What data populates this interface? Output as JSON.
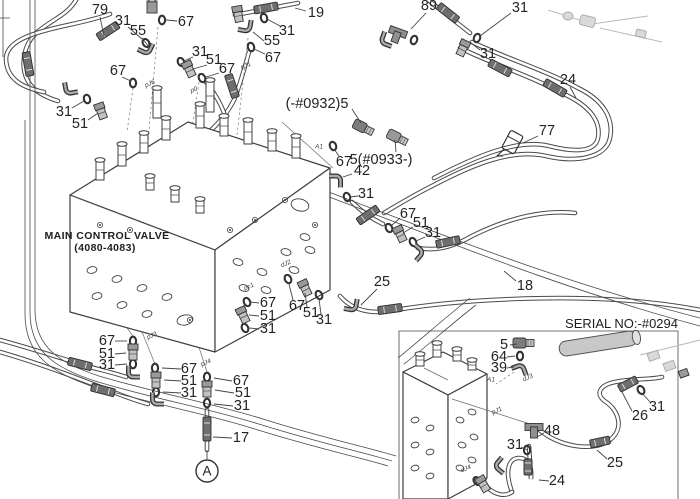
{
  "colors": {
    "background": "#ffffff",
    "line": "#4a4a4a",
    "label_text": "#232323",
    "sleeve": "#6e6e6e",
    "fitting": "#8f8f8f",
    "faded_part": "#bdbdbd"
  },
  "main_valve": {
    "label_line1": "MAIN CONTROL VALVE",
    "label_line2": "(4080-4083)"
  },
  "inset": {
    "serial_label": "SERIAL NO:-#0294"
  },
  "balloon": {
    "letter": "A"
  },
  "part_labels": [
    {
      "text": "79",
      "x": 100,
      "y": 10,
      "leader": [
        100,
        17,
        104,
        36
      ]
    },
    {
      "text": "31",
      "x": 123,
      "y": 21,
      "leader": [
        128,
        27,
        142,
        39
      ]
    },
    {
      "text": "55",
      "x": 138,
      "y": 31,
      "leader": [
        142,
        38,
        149,
        47
      ]
    },
    {
      "text": "67",
      "x": 186,
      "y": 22,
      "leader": [
        177,
        21,
        166,
        20
      ]
    },
    {
      "text": "31",
      "x": 200,
      "y": 52,
      "leader": [
        193,
        57,
        184,
        61
      ]
    },
    {
      "text": "51",
      "x": 214,
      "y": 60,
      "leader": [
        207,
        65,
        193,
        69
      ]
    },
    {
      "text": "67",
      "x": 227,
      "y": 69,
      "leader": [
        219,
        73,
        206,
        77
      ]
    },
    {
      "text": "67",
      "x": 118,
      "y": 71,
      "leader": [
        122,
        77,
        131,
        81
      ]
    },
    {
      "text": "31",
      "x": 64,
      "y": 112,
      "leader": [
        72,
        108,
        84,
        101
      ]
    },
    {
      "text": "51",
      "x": 80,
      "y": 124,
      "leader": [
        88,
        120,
        98,
        113
      ]
    },
    {
      "text": "19",
      "x": 316,
      "y": 13,
      "leader": [
        306,
        11,
        295,
        8
      ]
    },
    {
      "text": "31",
      "x": 287,
      "y": 31,
      "leader": [
        280,
        26,
        267,
        19
      ]
    },
    {
      "text": "55",
      "x": 272,
      "y": 41,
      "leader": [
        264,
        41,
        253,
        32
      ]
    },
    {
      "text": "67",
      "x": 273,
      "y": 58,
      "leader": [
        265,
        54,
        254,
        49
      ]
    },
    {
      "text": "89",
      "x": 429,
      "y": 6,
      "leader": [
        426,
        13,
        411,
        29
      ]
    },
    {
      "text": "31",
      "x": 520,
      "y": 8,
      "leader": [
        511,
        13,
        480,
        36
      ]
    },
    {
      "text": "31",
      "x": 488,
      "y": 54,
      "leader": [
        480,
        50,
        470,
        42
      ]
    },
    {
      "text": "24",
      "x": 568,
      "y": 80,
      "leader": [
        570,
        87,
        576,
        98
      ]
    },
    {
      "text": "77",
      "x": 547,
      "y": 131,
      "leader": [
        538,
        136,
        523,
        143
      ]
    },
    {
      "text": "(-#0932)5",
      "x": 317,
      "y": 104,
      "leader": [
        352,
        109,
        361,
        123
      ]
    },
    {
      "text": "5(#0933-)",
      "x": 381,
      "y": 160,
      "leader": [
        396,
        152,
        395,
        140
      ]
    },
    {
      "text": "67",
      "x": 344,
      "y": 162,
      "leader": [
        339,
        156,
        334,
        149
      ]
    },
    {
      "text": "42",
      "x": 362,
      "y": 171,
      "leader": [
        352,
        174,
        343,
        177
      ]
    },
    {
      "text": "31",
      "x": 366,
      "y": 194,
      "leader": [
        358,
        196,
        350,
        197
      ]
    },
    {
      "text": "67",
      "x": 408,
      "y": 214,
      "leader": [
        400,
        218,
        391,
        226
      ]
    },
    {
      "text": "51",
      "x": 421,
      "y": 223,
      "leader": [
        413,
        227,
        403,
        233
      ]
    },
    {
      "text": "31",
      "x": 433,
      "y": 233,
      "leader": [
        425,
        237,
        416,
        241
      ]
    },
    {
      "text": "25",
      "x": 382,
      "y": 282,
      "leader": [
        377,
        289,
        361,
        305
      ]
    },
    {
      "text": "18",
      "x": 525,
      "y": 286,
      "leader": [
        516,
        281,
        504,
        271
      ]
    },
    {
      "text": "67",
      "x": 268,
      "y": 303,
      "leader": [
        259,
        303,
        250,
        302
      ]
    },
    {
      "text": "51",
      "x": 268,
      "y": 316,
      "leader": [
        259,
        316,
        249,
        315
      ]
    },
    {
      "text": "31",
      "x": 268,
      "y": 329,
      "leader": [
        259,
        329,
        249,
        328
      ]
    },
    {
      "text": "67",
      "x": 297,
      "y": 306,
      "leader": [
        293,
        300,
        289,
        284
      ]
    },
    {
      "text": "51",
      "x": 311,
      "y": 313,
      "leader": [
        307,
        307,
        305,
        293
      ]
    },
    {
      "text": "31",
      "x": 324,
      "y": 320,
      "leader": [
        321,
        314,
        319,
        299
      ]
    },
    {
      "text": "67",
      "x": 107,
      "y": 341,
      "leader": [
        115,
        341,
        127,
        341
      ]
    },
    {
      "text": "51",
      "x": 107,
      "y": 354,
      "leader": [
        115,
        354,
        126,
        353
      ]
    },
    {
      "text": "31",
      "x": 107,
      "y": 365,
      "leader": [
        115,
        365,
        127,
        364
      ]
    },
    {
      "text": "67",
      "x": 189,
      "y": 369,
      "leader": [
        181,
        369,
        162,
        368
      ]
    },
    {
      "text": "51",
      "x": 189,
      "y": 381,
      "leader": [
        181,
        381,
        164,
        380
      ]
    },
    {
      "text": "31",
      "x": 189,
      "y": 393,
      "leader": [
        181,
        393,
        163,
        392
      ]
    },
    {
      "text": "67",
      "x": 241,
      "y": 381,
      "leader": [
        232,
        381,
        214,
        378
      ]
    },
    {
      "text": "51",
      "x": 243,
      "y": 393,
      "leader": [
        234,
        393,
        215,
        390
      ]
    },
    {
      "text": "31",
      "x": 242,
      "y": 406,
      "leader": [
        233,
        406,
        214,
        404
      ]
    },
    {
      "text": "17",
      "x": 241,
      "y": 438,
      "leader": [
        232,
        438,
        213,
        437
      ]
    },
    {
      "text": "5",
      "x": 504,
      "y": 345,
      "leader": [
        510,
        345,
        517,
        344
      ]
    },
    {
      "text": "64",
      "x": 499,
      "y": 357,
      "leader": [
        507,
        357,
        515,
        356
      ]
    },
    {
      "text": "39",
      "x": 499,
      "y": 368,
      "leader": [
        507,
        368,
        514,
        367
      ]
    },
    {
      "text": "31",
      "x": 657,
      "y": 407,
      "leader": [
        650,
        402,
        642,
        393
      ]
    },
    {
      "text": "26",
      "x": 640,
      "y": 416,
      "leader": [
        632,
        411,
        622,
        392
      ]
    },
    {
      "text": "48",
      "x": 552,
      "y": 431,
      "leader": [
        544,
        433,
        537,
        437
      ]
    },
    {
      "text": "31",
      "x": 515,
      "y": 445,
      "leader": [
        521,
        447,
        527,
        450
      ]
    },
    {
      "text": "25",
      "x": 615,
      "y": 463,
      "leader": [
        607,
        459,
        597,
        450
      ]
    },
    {
      "text": "24",
      "x": 557,
      "y": 481,
      "leader": [
        549,
        481,
        539,
        480
      ]
    }
  ],
  "port_labels": [
    {
      "text": "pJ6",
      "x": 150,
      "y": 84,
      "rot": -22
    },
    {
      "text": "p0",
      "x": 194,
      "y": 90,
      "rot": -22
    },
    {
      "text": "pJ1",
      "x": 246,
      "y": 66,
      "rot": -22
    },
    {
      "text": "A1",
      "x": 319,
      "y": 147,
      "rot": 0
    },
    {
      "text": "dJ2",
      "x": 286,
      "y": 264,
      "rot": -22
    },
    {
      "text": "pc1",
      "x": 249,
      "y": 287,
      "rot": -22
    },
    {
      "text": "pJ3",
      "x": 152,
      "y": 336,
      "rot": -22
    },
    {
      "text": "pJ4",
      "x": 206,
      "y": 363,
      "rot": -22
    },
    {
      "text": "A1",
      "x": 491,
      "y": 380,
      "rot": 0
    },
    {
      "text": "dJ3",
      "x": 528,
      "y": 378,
      "rot": -22
    },
    {
      "text": "pJ1",
      "x": 497,
      "y": 411,
      "rot": -22
    },
    {
      "text": "dJ4",
      "x": 466,
      "y": 469,
      "rot": -22
    }
  ]
}
